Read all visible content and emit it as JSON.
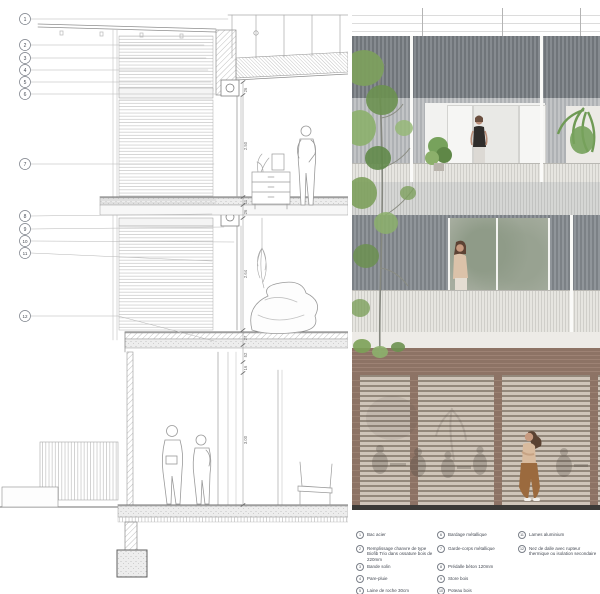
{
  "sheet": {
    "background": "#ffffff"
  },
  "section": {
    "callouts": [
      "1",
      "2",
      "3",
      "4",
      "5",
      "6",
      "7",
      "8",
      "9",
      "10",
      "11",
      "12"
    ],
    "dims": [
      "26",
      "2.50",
      "11",
      "26",
      "2.64",
      "27",
      "52",
      "16",
      "3.00"
    ],
    "line_color": "#9e9e9e"
  },
  "legend": {
    "items": [
      {
        "num": "1",
        "text": "Bac acier"
      },
      {
        "num": "2",
        "text": "Remplissage chanvre de type Biofib Trio dans ossature bois de 220mm"
      },
      {
        "num": "3",
        "text": "Bande solin"
      },
      {
        "num": "4",
        "text": "Pare-pluie"
      },
      {
        "num": "5",
        "text": "Laine de roche 30cm"
      },
      {
        "num": "6",
        "text": "Bardage métallique"
      },
      {
        "num": "7",
        "text": "Garde-corps métallique"
      },
      {
        "num": "8",
        "text": "Prédalle béton 120mm"
      },
      {
        "num": "9",
        "text": "Store bois"
      },
      {
        "num": "10",
        "text": "Poteau bois"
      },
      {
        "num": "11",
        "text": "Lames aluminium"
      },
      {
        "num": "12",
        "text": "Nez de dalle avec rupteur thermique ou isolation secondaire"
      }
    ]
  },
  "render": {
    "colors": {
      "dark_cladding": "#787d82",
      "light_cladding": "#b5b8ba",
      "railing_slats": "#dcdbd6",
      "brick": "#8d7365",
      "louver_light": "#cfc5b9",
      "louver_dark": "#93887b",
      "foliage": "#7da05c",
      "glass_reflection": "#a3ab9f",
      "base_line": "#3b3a37"
    }
  }
}
